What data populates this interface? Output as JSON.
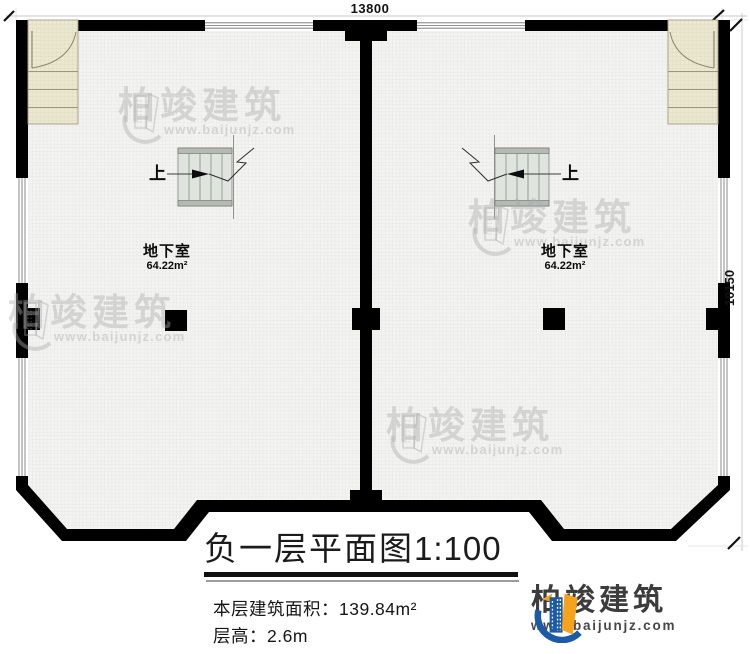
{
  "dimensions": {
    "top_width": "13800",
    "right_height": "10150"
  },
  "plan": {
    "rooms": [
      {
        "name": "地下室",
        "area": "64.22m²",
        "stair_up": "上"
      },
      {
        "name": "地下室",
        "area": "64.22m²",
        "stair_up": "上"
      }
    ]
  },
  "title_block": {
    "title": "负一层平面图",
    "scale": "1:100",
    "area_label": "本层建筑面积：",
    "area_value": "139.84m²",
    "height_label": "层高：",
    "height_value": "2.6m"
  },
  "watermark": {
    "brand": "柏竣建筑",
    "url": "www.baijunjz.com"
  },
  "logo": {
    "brand": "柏竣建筑",
    "url": "www.baijunjz.com",
    "blue": "#1b5aa5",
    "orange": "#f7a21d"
  },
  "colors": {
    "wall": "#000000",
    "exterior_stair": "#ebe8d1",
    "interior_stair": "#dfe4de"
  }
}
